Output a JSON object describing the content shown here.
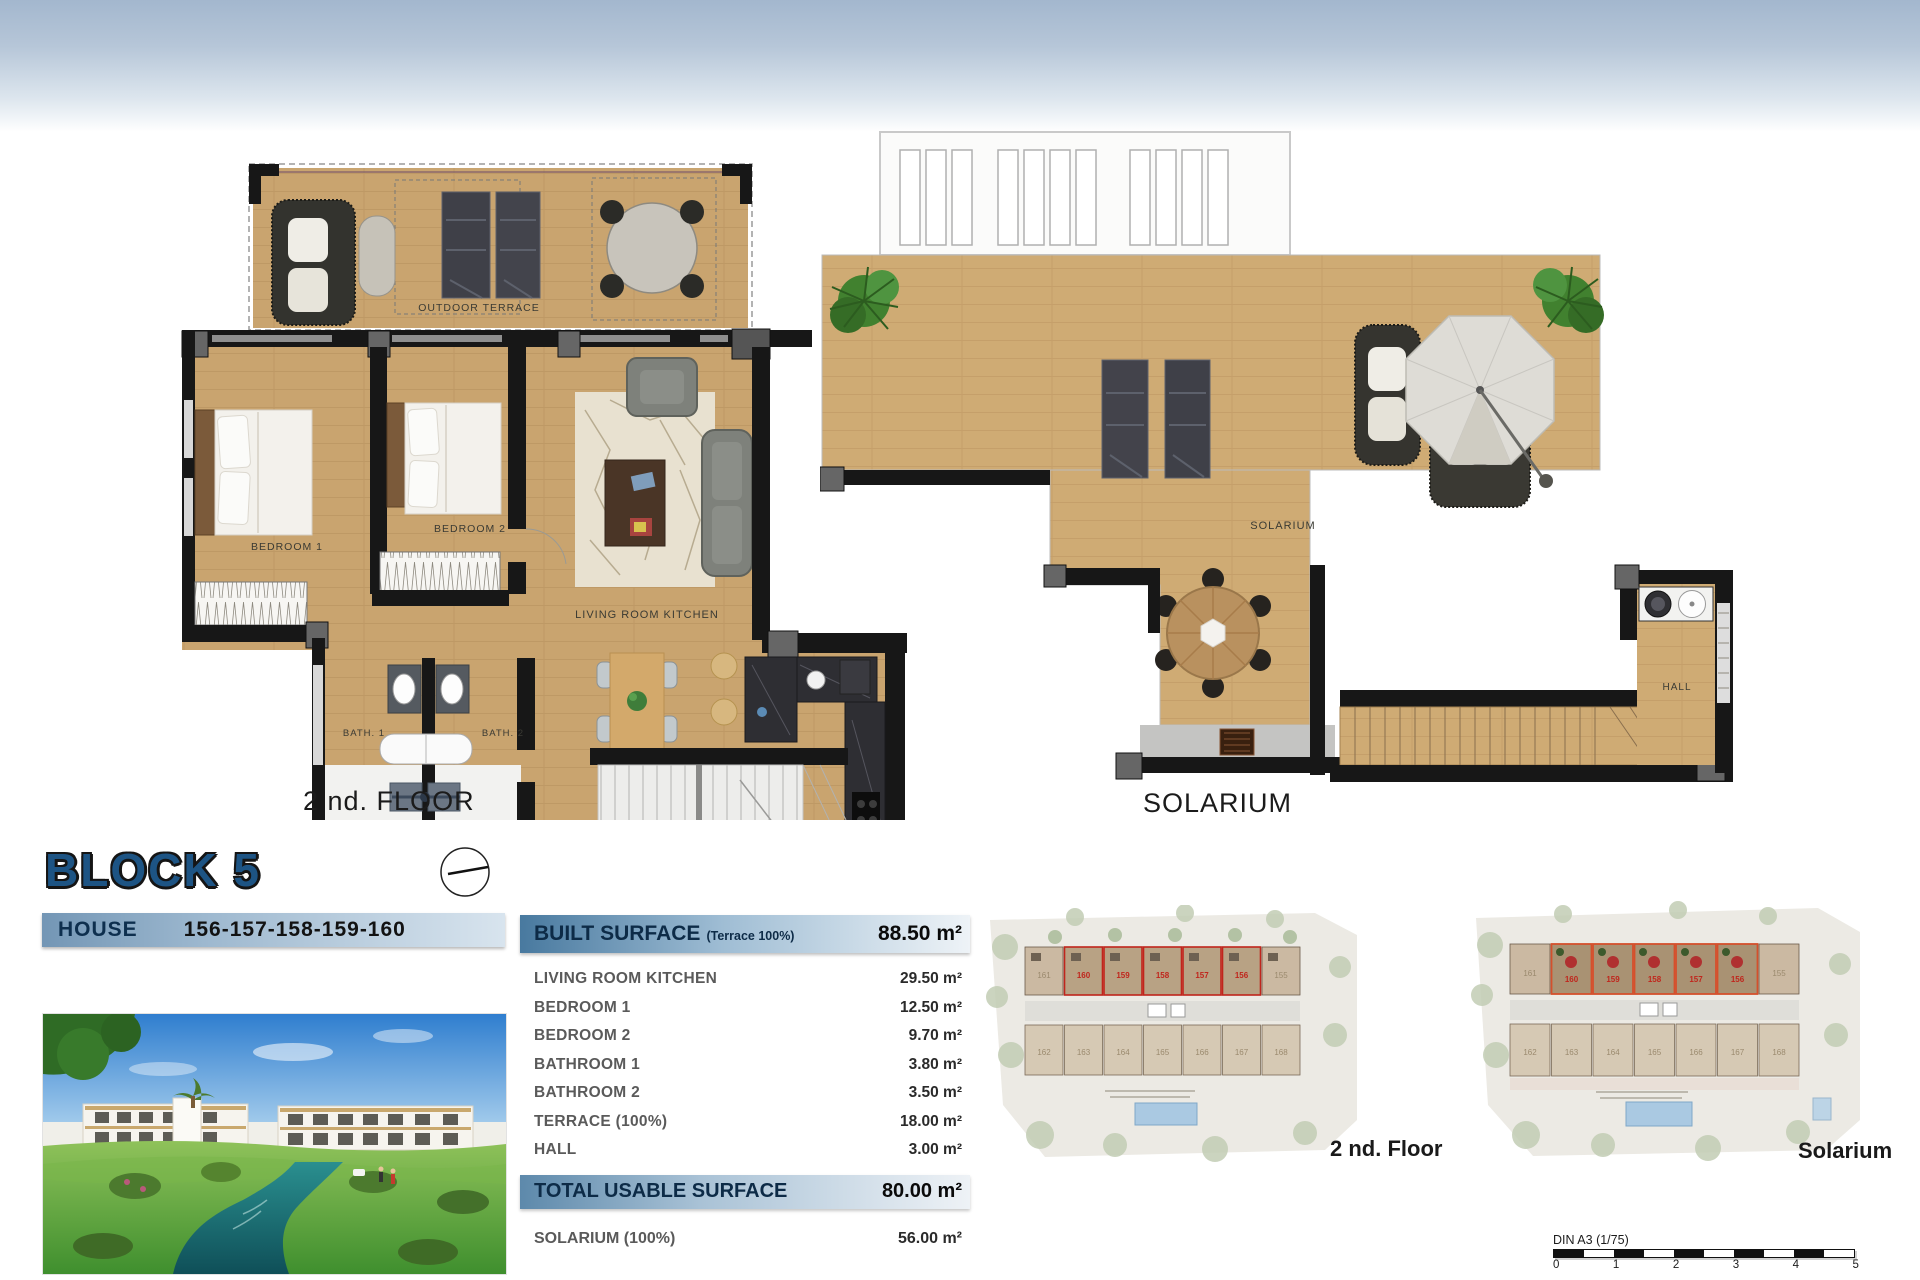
{
  "plans": {
    "floor": {
      "caption": "2 nd. FLOOR",
      "terrace": "OUTDOOR TERRACE",
      "bedroom1": "BEDROOM 1",
      "bedroom2": "BEDROOM 2",
      "living": "LIVING ROOM KITCHEN",
      "bath1": "BATH. 1",
      "bath2": "BATH. 2"
    },
    "solarium": {
      "caption": "SOLARIUM",
      "room": "SOLARIUM",
      "hall": "HALL"
    }
  },
  "block": {
    "title": "BLOCK 5",
    "house_label": "HOUSE",
    "house_numbers": "156-157-158-159-160"
  },
  "surface_table": {
    "header": {
      "label": "BUILT SURFACE",
      "note": "(Terrace 100%)",
      "value": "88.50 m²"
    },
    "rows": [
      {
        "label": "LIVING ROOM KITCHEN",
        "value": "29.50 m²"
      },
      {
        "label": "BEDROOM 1",
        "value": "12.50 m²"
      },
      {
        "label": "BEDROOM 2",
        "value": "9.70 m²"
      },
      {
        "label": "BATHROOM 1",
        "value": "3.80 m²"
      },
      {
        "label": "BATHROOM 2",
        "value": "3.50 m²"
      },
      {
        "label": "TERRACE (100%)",
        "value": "18.00 m²"
      },
      {
        "label": "HALL",
        "value": "3.00 m²"
      }
    ],
    "total": {
      "label": "TOTAL USABLE SURFACE",
      "value": "80.00 m²"
    },
    "extra": {
      "label": "SOLARIUM (100%)",
      "value": "56.00 m²"
    }
  },
  "site_plans": [
    {
      "label": "2 nd. Floor",
      "units_top": [
        "161",
        "160",
        "159",
        "158",
        "157",
        "156",
        "155"
      ],
      "units_bottom": [
        "162",
        "163",
        "164",
        "165",
        "166",
        "167",
        "168"
      ]
    },
    {
      "label": "Solarium",
      "units_top": [
        "161",
        "160",
        "159",
        "158",
        "157",
        "156",
        "155"
      ],
      "units_bottom": [
        "162",
        "163",
        "164",
        "165",
        "166",
        "167",
        "168"
      ]
    }
  ],
  "scale_bar": {
    "label": "DIN A3 (1/75)",
    "ticks": [
      "0",
      "1",
      "2",
      "3",
      "4",
      "5"
    ]
  },
  "colors": {
    "accent_blue": "#1d5484",
    "bar_blue_dark": "#48799f",
    "bar_blue_light": "#eef3f7",
    "sky_top": "#a3b7ce",
    "wood": "#c9a46f",
    "wall": "#171717",
    "highlight_red": "#c0251c",
    "pool_blue": "#aac9e2"
  }
}
